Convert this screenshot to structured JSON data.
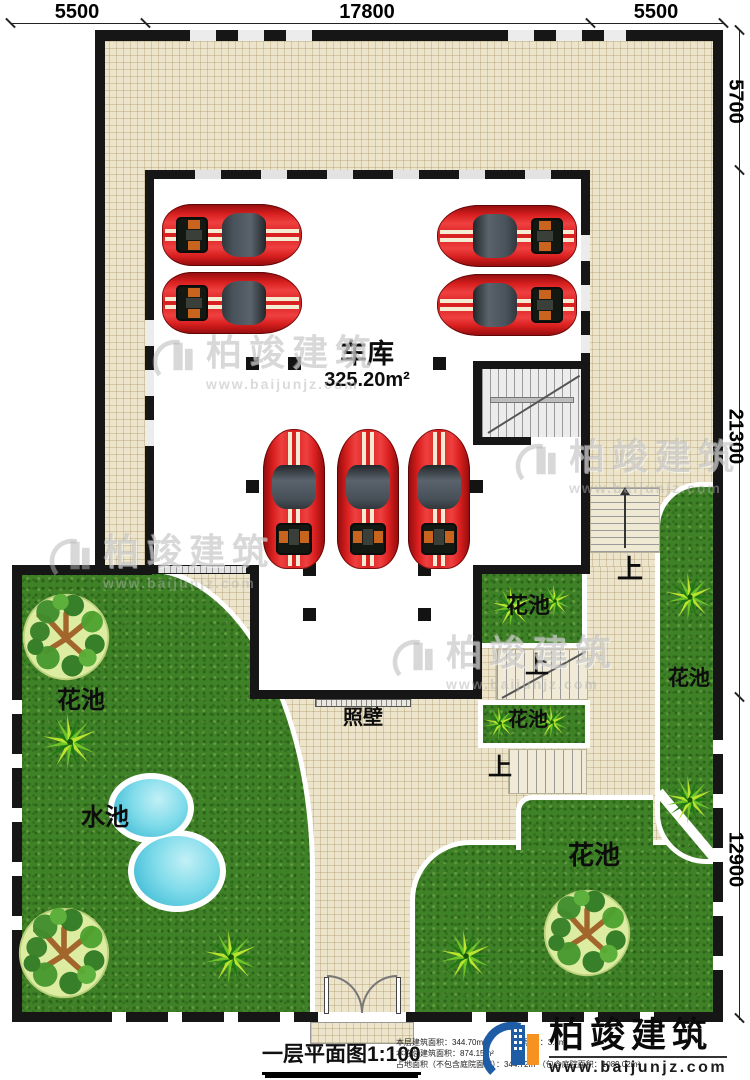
{
  "dimensions": {
    "top": [
      "5500",
      "17800",
      "5500"
    ],
    "right": [
      "5700",
      "21300",
      "12900"
    ]
  },
  "rooms": {
    "garage": {
      "name": "车库",
      "area": "325.20m²"
    }
  },
  "labels": {
    "flower_bed": "花池",
    "water_pool": "水池",
    "screen_wall": "照壁",
    "up": "上"
  },
  "title_block": {
    "title": "一层平面图1:100",
    "stats": [
      "本层建筑面积：344.70m²",
      "层高：3.3m",
      "本栋总建筑面积：874.15m²",
      "占地面积（不包含庭院面积）：344.72m²（包含庭院面积：1089.02m²"
    ]
  },
  "brand": {
    "name": "柏竣建筑",
    "url": "www.baijunjz.com"
  },
  "watermark": {
    "name": "柏竣建筑",
    "url": "www.baijunjz.com"
  },
  "colors": {
    "wall": "#161616",
    "tile": "#ece4cb",
    "grass": "#3f8127",
    "car_red": "#d81f1f",
    "pool_blue": "#49c0d8",
    "brand_blue": "#1e5ca6",
    "brand_orange": "#f6921e"
  },
  "plan_items": {
    "cars": [
      {
        "cx": 232,
        "cy": 235,
        "rot": 90
      },
      {
        "cx": 232,
        "cy": 303,
        "rot": 90
      },
      {
        "cx": 507,
        "cy": 236,
        "rot": -90
      },
      {
        "cx": 507,
        "cy": 305,
        "rot": -90
      },
      {
        "cx": 294,
        "cy": 499,
        "rot": 0
      },
      {
        "cx": 368,
        "cy": 499,
        "rot": 0
      },
      {
        "cx": 439,
        "cy": 499,
        "rot": 0
      }
    ],
    "trees": [
      {
        "cx": 66,
        "cy": 637,
        "r": 45
      },
      {
        "cx": 64,
        "cy": 953,
        "r": 47
      },
      {
        "cx": 587,
        "cy": 933,
        "r": 45
      }
    ],
    "ferns": [
      {
        "cx": 70,
        "cy": 742,
        "r": 30
      },
      {
        "cx": 231,
        "cy": 957,
        "r": 29
      },
      {
        "cx": 466,
        "cy": 956,
        "r": 28
      },
      {
        "cx": 690,
        "cy": 597,
        "r": 26
      },
      {
        "cx": 690,
        "cy": 800,
        "r": 26
      },
      {
        "cx": 512,
        "cy": 607,
        "r": 23
      },
      {
        "cx": 555,
        "cy": 601,
        "r": 18
      },
      {
        "cx": 500,
        "cy": 723,
        "r": 18
      },
      {
        "cx": 552,
        "cy": 722,
        "r": 18
      }
    ],
    "columns": [
      [
        246,
        357
      ],
      [
        288,
        357
      ],
      [
        433,
        357
      ],
      [
        246,
        480
      ],
      [
        470,
        480
      ],
      [
        303,
        563
      ],
      [
        418,
        563
      ],
      [
        303,
        608
      ],
      [
        418,
        608
      ]
    ],
    "watermarks": [
      {
        "cx": 265,
        "cy": 358
      },
      {
        "cx": 628,
        "cy": 462
      },
      {
        "cx": 162,
        "cy": 557
      },
      {
        "cx": 505,
        "cy": 658
      }
    ]
  }
}
